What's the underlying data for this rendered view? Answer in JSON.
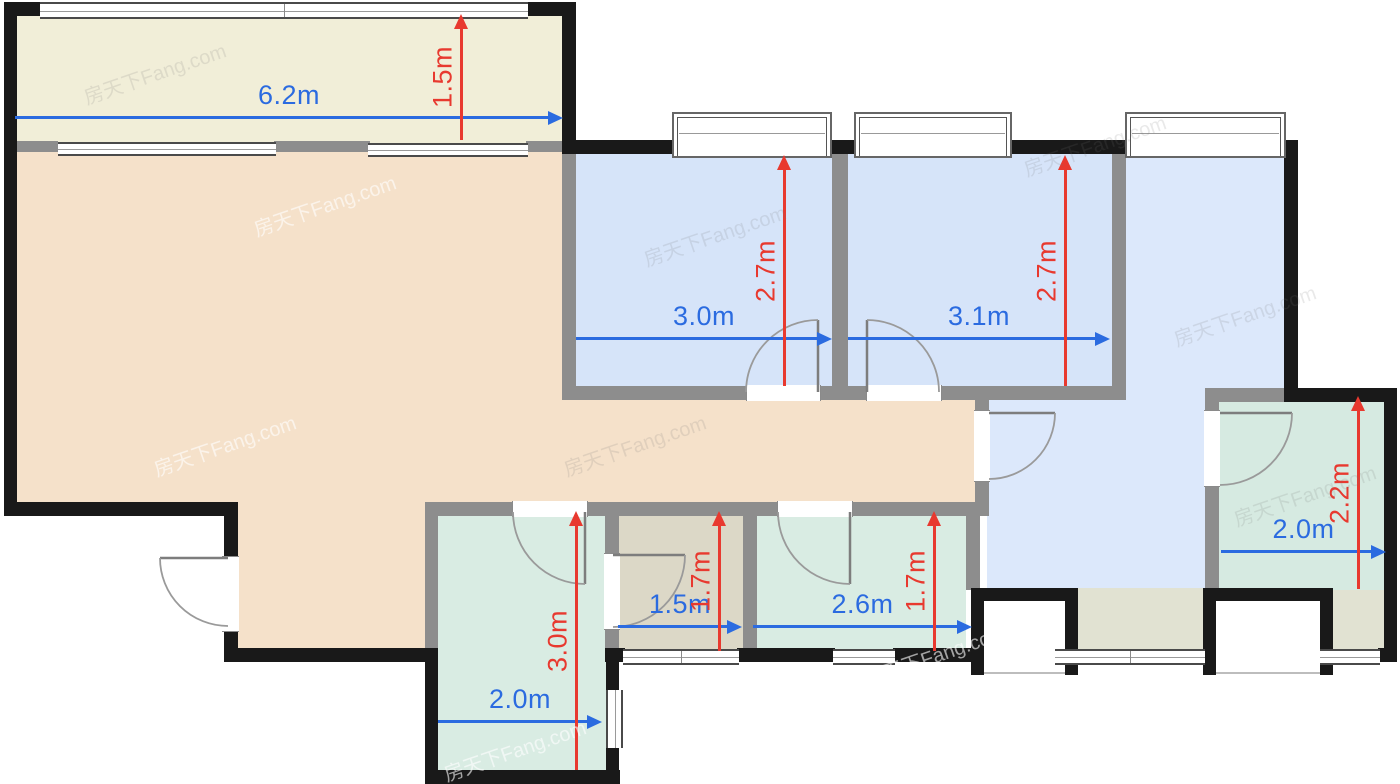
{
  "palette": {
    "wall_black": "#191919",
    "wall_gray": "#8d8d8d",
    "dim_blue": "#2b6be0",
    "dim_red": "#e8392f",
    "balcony": "#f1eed8",
    "living": "#f5e1ca",
    "bedroom": "#d6e4f9",
    "kitchen_hall": "#dce8fb",
    "bath_green": "#d9ece3",
    "wc_gray": "#dcd8c7",
    "storage_green": "#d6eae1",
    "bottom_strip": "#e1e2d2"
  },
  "watermark": {
    "text": "房天下Fang.com"
  },
  "dimensions": [
    {
      "id": "balcony-width",
      "label": "6.2m",
      "orientation": "horizontal"
    },
    {
      "id": "balcony-depth",
      "label": "1.5m",
      "orientation": "vertical"
    },
    {
      "id": "bedroom1-width",
      "label": "3.0m",
      "orientation": "horizontal"
    },
    {
      "id": "bedroom1-depth",
      "label": "2.7m",
      "orientation": "vertical"
    },
    {
      "id": "bedroom2-width",
      "label": "3.1m",
      "orientation": "horizontal"
    },
    {
      "id": "bedroom2-depth",
      "label": "2.7m",
      "orientation": "vertical"
    },
    {
      "id": "storage-width",
      "label": "2.0m",
      "orientation": "horizontal"
    },
    {
      "id": "storage-depth",
      "label": "2.2m",
      "orientation": "vertical"
    },
    {
      "id": "bathroom-width",
      "label": "2.0m",
      "orientation": "horizontal"
    },
    {
      "id": "bathroom-depth",
      "label": "3.0m",
      "orientation": "vertical"
    },
    {
      "id": "wc-width",
      "label": "1.5m",
      "orientation": "horizontal"
    },
    {
      "id": "wc-depth",
      "label": "1.7m",
      "orientation": "vertical"
    },
    {
      "id": "utility-width",
      "label": "2.6m",
      "orientation": "horizontal"
    },
    {
      "id": "utility-depth",
      "label": "1.7m",
      "orientation": "vertical"
    }
  ]
}
